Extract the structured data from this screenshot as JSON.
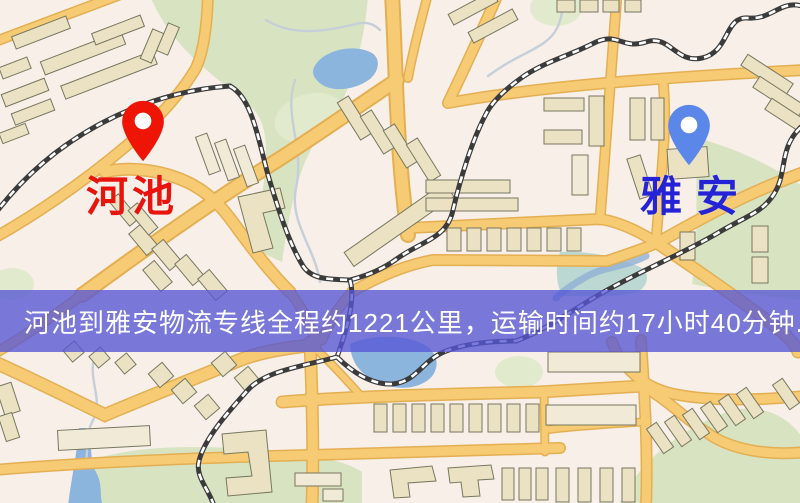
{
  "route_banner": {
    "text": "河池到雅安物流专线全程约1221公里，运输时间约17小时40分钟.",
    "origin": "河池",
    "destination": "雅安",
    "distance_km": "1221",
    "duration": "17小时40分钟"
  },
  "map_labels": {
    "origin": {
      "text": "河池"
    },
    "destination": {
      "text": "雅安"
    }
  },
  "icons": {
    "origin_pin": "red-map-pin",
    "destination_pin": "blue-map-pin"
  },
  "theme": {
    "bg": "#f7efe8",
    "park": "#d8e3c1",
    "park_light": "#e2eacd",
    "water": "#8cb5de",
    "teal": "#b2d4cf",
    "stream": "#c6cfd8",
    "stream_blue": "#8fb0d6",
    "road": "#f6cb74",
    "road_casing": "#e4af52",
    "rail": "#3b3b3b",
    "building": "#ebe2c4",
    "building_light": "#f1ead6",
    "building_line": "#77775f",
    "origin": "#e8150f",
    "destination": "#2424d6",
    "origin_pin": "#ee1506",
    "destination_pin": "#5b87e8",
    "banner_bg": "#5656d5",
    "banner_opacity": "0.78",
    "banner_text": "#ffffff"
  }
}
